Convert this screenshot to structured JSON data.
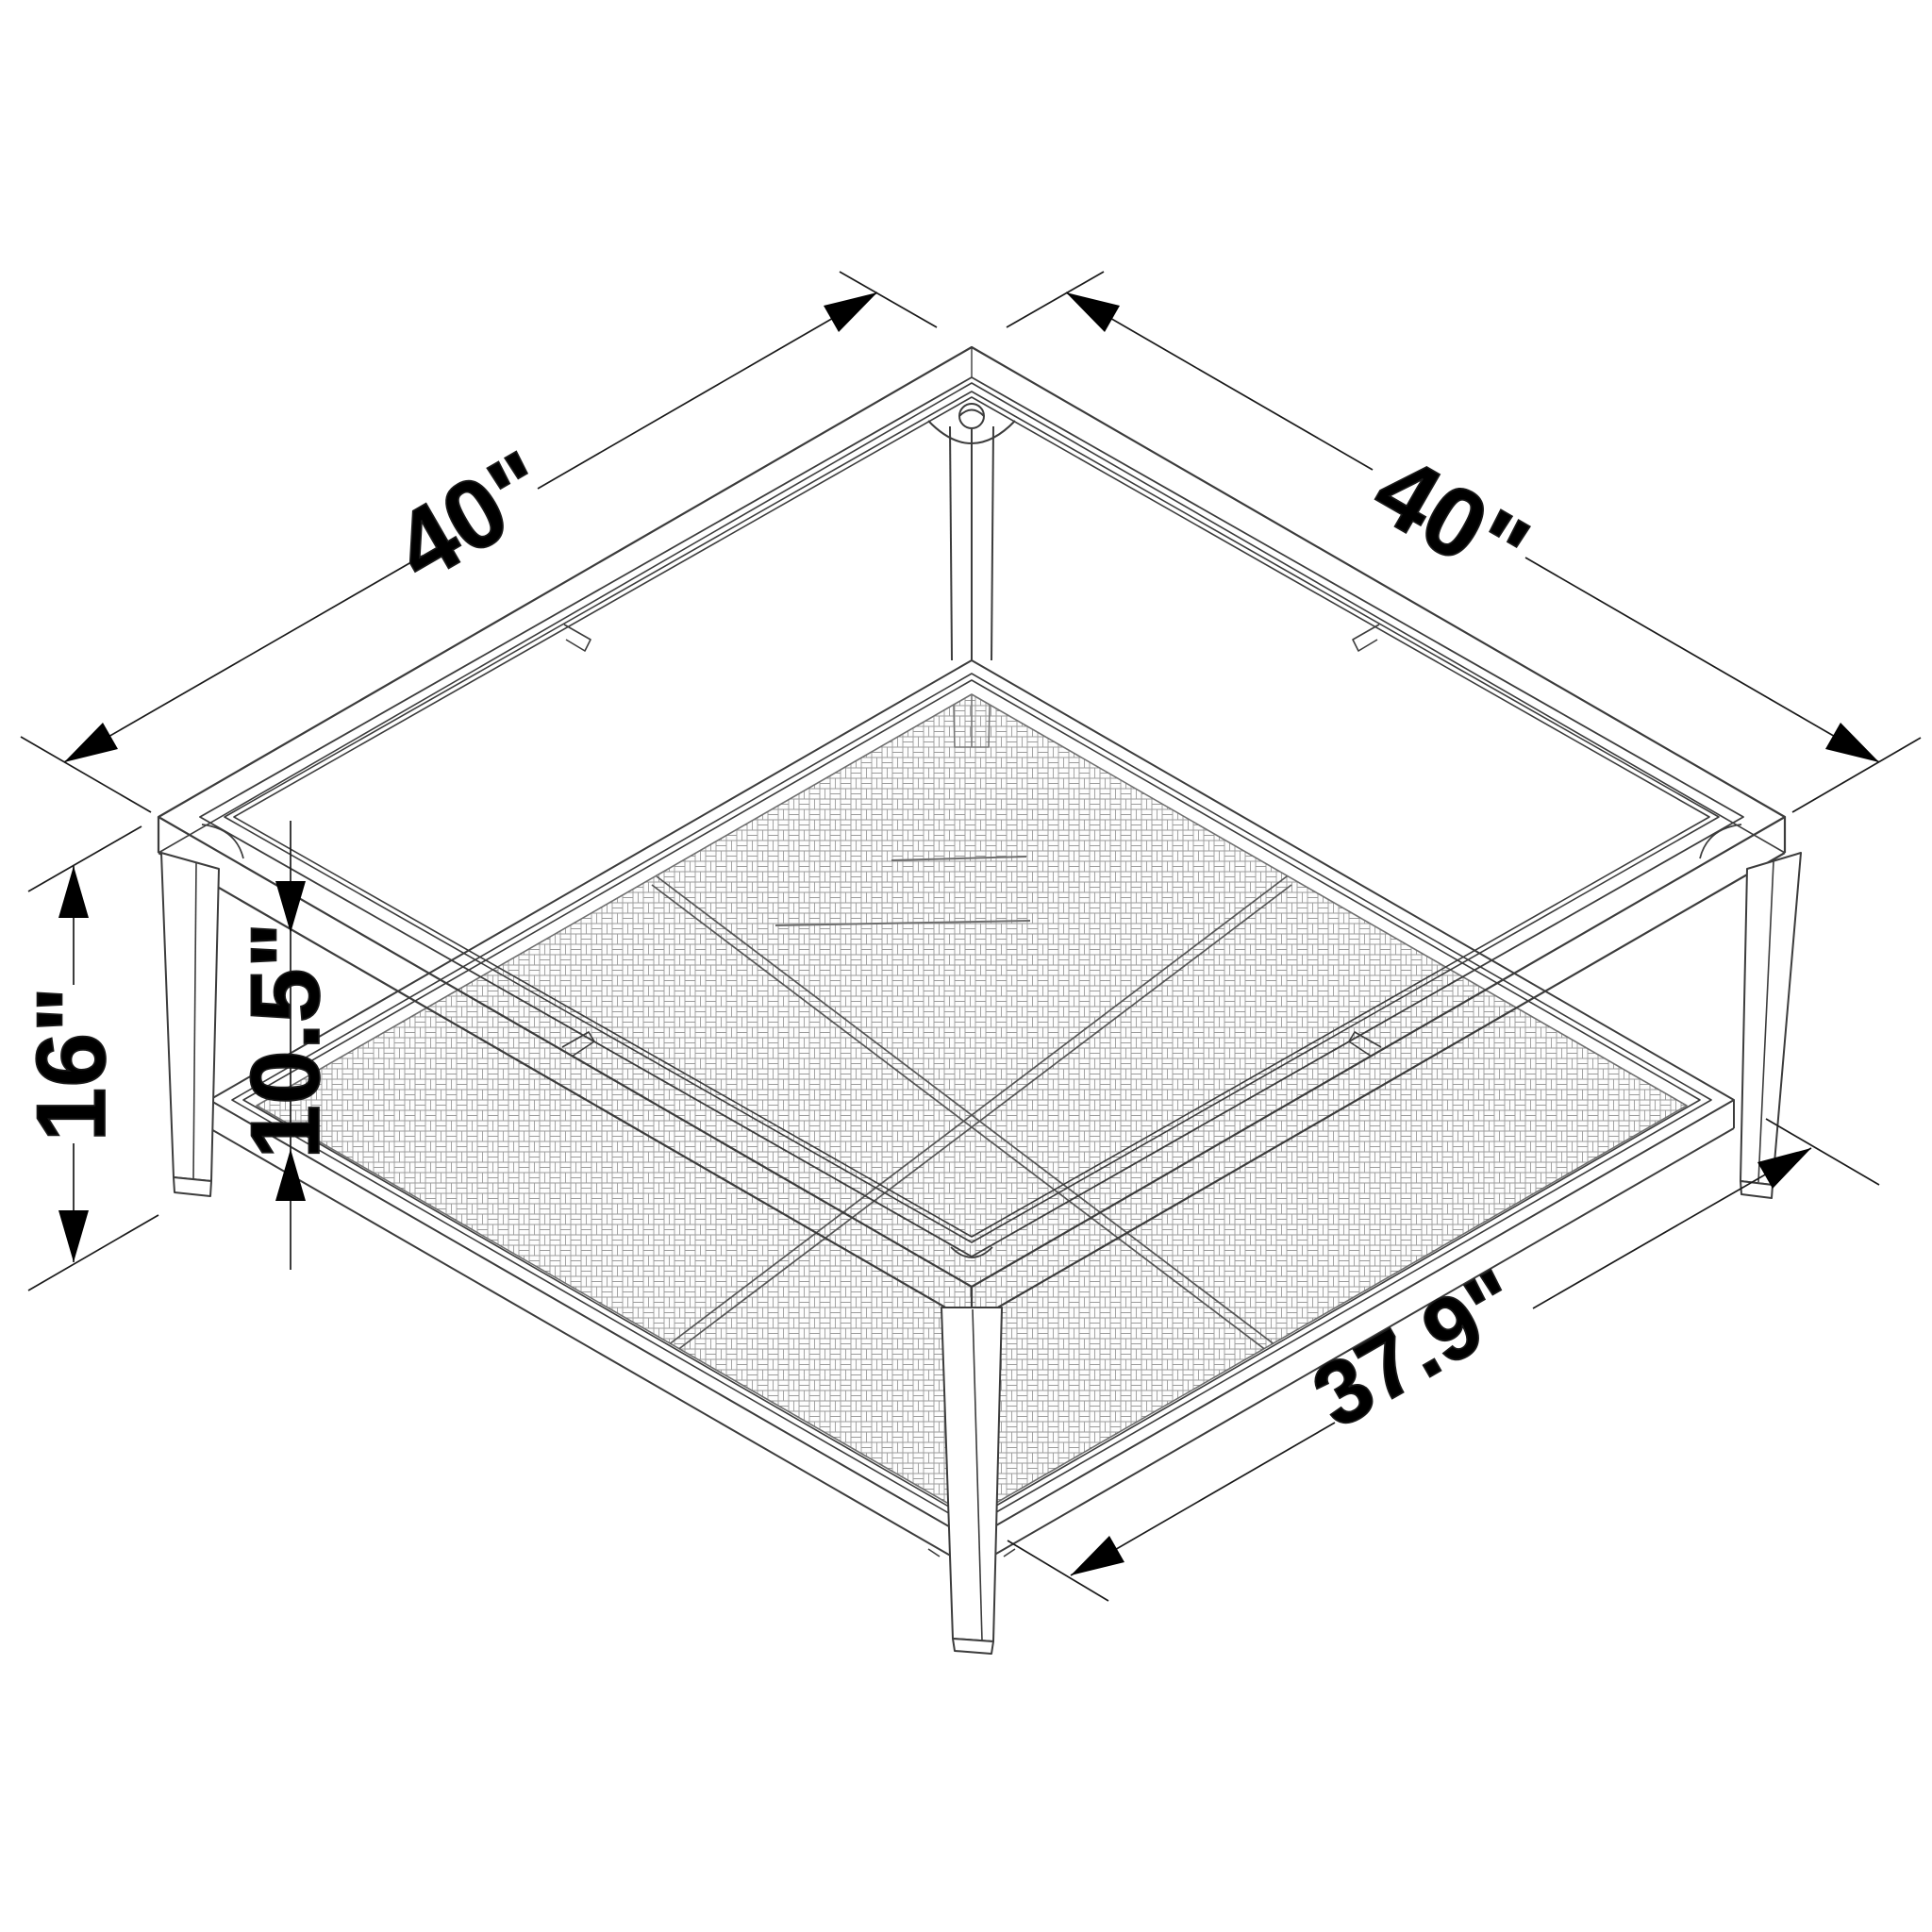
{
  "diagram": {
    "type": "isometric-technical-drawing",
    "subject": "square coffee table with glass top, metal frame and woven lower shelf",
    "colors": {
      "background": "#ffffff",
      "line": "#3c3c3c",
      "dimension_line": "#1a1a1a",
      "arrow": "#000000",
      "mesh_line": "#9b9b9b"
    },
    "dimensions": {
      "top_edge_left": {
        "label": "40\""
      },
      "top_edge_right": {
        "label": "40\""
      },
      "overall_height": {
        "label": "16\""
      },
      "shelf_clearance": {
        "label": "10.5\""
      },
      "shelf_width": {
        "label": "37.9\""
      }
    }
  }
}
